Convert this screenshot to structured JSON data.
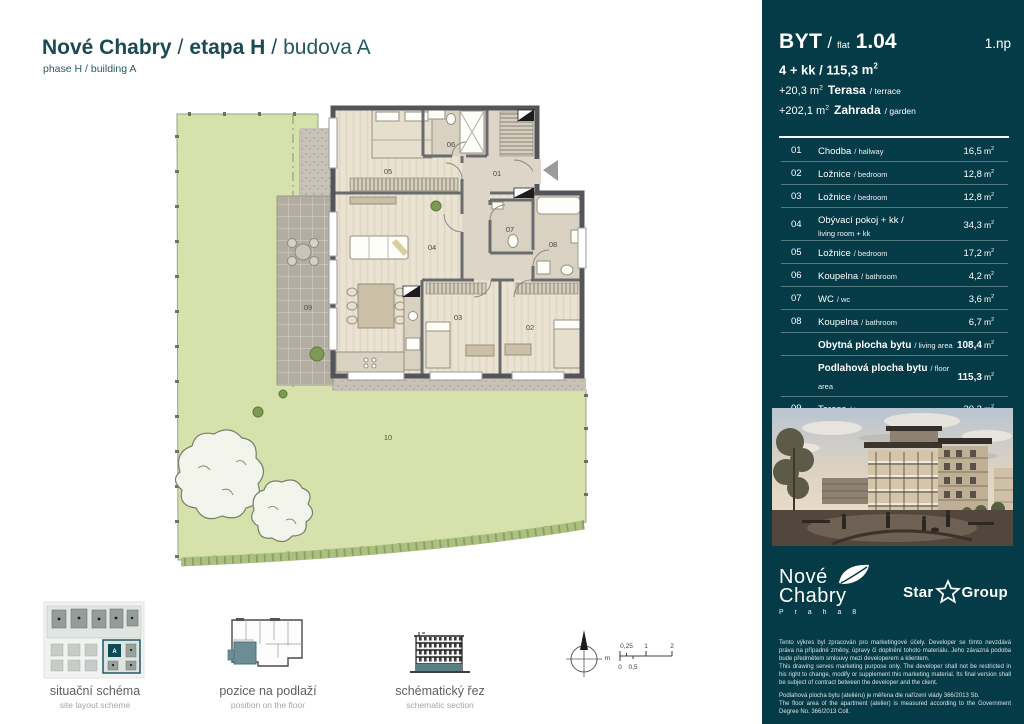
{
  "colors": {
    "sidebar_bg": "#043b46",
    "accent_teal": "#0c4b55",
    "garden_green": "#d6e1ac",
    "title_teal": "#1a4a53"
  },
  "header": {
    "part1": "Nové Chabry",
    "sep1": "/",
    "part2": "etapa H",
    "sep2": "/",
    "part3": "budova A",
    "subtitle": "phase H / building A"
  },
  "plan": {
    "labels": {
      "r01": "01",
      "r02": "02",
      "r03": "03",
      "r04": "04",
      "r05": "05",
      "r06": "06",
      "r07": "07",
      "r08": "08",
      "r09": "09",
      "r10": "10"
    },
    "scale": {
      "unit": "m",
      "t025": "0,25",
      "t1": "1",
      "t2": "2",
      "b0": "0",
      "b05": "0,5"
    }
  },
  "thumbnails": [
    {
      "title": "situační schéma",
      "subtitle": "site layout scheme",
      "block_label": "A"
    },
    {
      "title": "pozice na podlaží",
      "subtitle": "position on the floor"
    },
    {
      "title": "schématický řez",
      "subtitle": "schematic section"
    }
  ],
  "sidebar": {
    "unit": "m",
    "unit_sup": "2",
    "flat_label": "BYT",
    "flat_sep": "/",
    "flat_word": "flat",
    "flat_number": "1.04",
    "floor": "1.np",
    "layout": "4 + kk / 115,3",
    "terrace_plus": "+20,3",
    "terrace_name": "Terasa",
    "terrace_sub": "/ terrace",
    "garden_plus": "+202,1",
    "garden_name": "Zahrada",
    "garden_sub": "/ garden",
    "rows": [
      {
        "no": "01",
        "name": "Chodba",
        "sub": "/ hallway",
        "value": "16,5"
      },
      {
        "no": "02",
        "name": "Ložnice",
        "sub": "/ bedroom",
        "value": "12,8"
      },
      {
        "no": "03",
        "name": "Ložnice",
        "sub": "/ bedroom",
        "value": "12,8"
      },
      {
        "no": "04",
        "name": "Obývací pokoj + kk /",
        "name2": "living room + kk",
        "value": "34,3"
      },
      {
        "no": "05",
        "name": "Ložnice",
        "sub": "/ bedroom",
        "value": "17,2"
      },
      {
        "no": "06",
        "name": "Koupelna",
        "sub": "/ bathroom",
        "value": "4,2"
      },
      {
        "no": "07",
        "name": "WC",
        "sub": "/ wc",
        "value": "3,6"
      },
      {
        "no": "08",
        "name": "Koupelna",
        "sub": "/ bathroom",
        "value": "6,7"
      },
      {
        "name": "Obytná plocha bytu",
        "sub": "/ living area",
        "value": "108,4",
        "bold": true
      },
      {
        "name": "Podlahová plocha bytu",
        "sub": "/ floor area",
        "value": "115,3",
        "bold": true
      },
      {
        "no": "09",
        "name": "Terasa",
        "sub": "/ terrace",
        "value": "20,3"
      },
      {
        "no": "10",
        "name": "Zahrada",
        "sub": "/ garden",
        "value": "202,1"
      },
      {
        "name": "Celková plocha",
        "sub": "/ total area",
        "value": "337,7",
        "bold": true,
        "topline": true
      }
    ]
  },
  "logos": {
    "brand_line1": "Nové",
    "brand_line2": "Chabry",
    "brand_city": "P r a h a   8",
    "partner_word1": "Star",
    "partner_word2": "Group"
  },
  "disclaimer": {
    "cz1": "Tento výkres byl zpracován pro marketingové účely. Developer se tímto nevzdává práva na případné změny, úpravy či doplnění tohoto materiálu. Jeho závazná podoba bude předmětem smlouvy mezi developerem a klientem.",
    "en1": "This drawing serves marketing purpose only. The developer shall not be restricted in his right to change, modify or supplement this marketing material. Its final version shall be subject of contract between the developer and the client.",
    "cz2": "Podlahová plocha bytu (ateliéru) je měřena dle nařízení vlády 366/2013 Sb.",
    "en2": "The floor area of the apartment (atelier) is measured according to the Government Degree No. 366/2013 Coll."
  }
}
